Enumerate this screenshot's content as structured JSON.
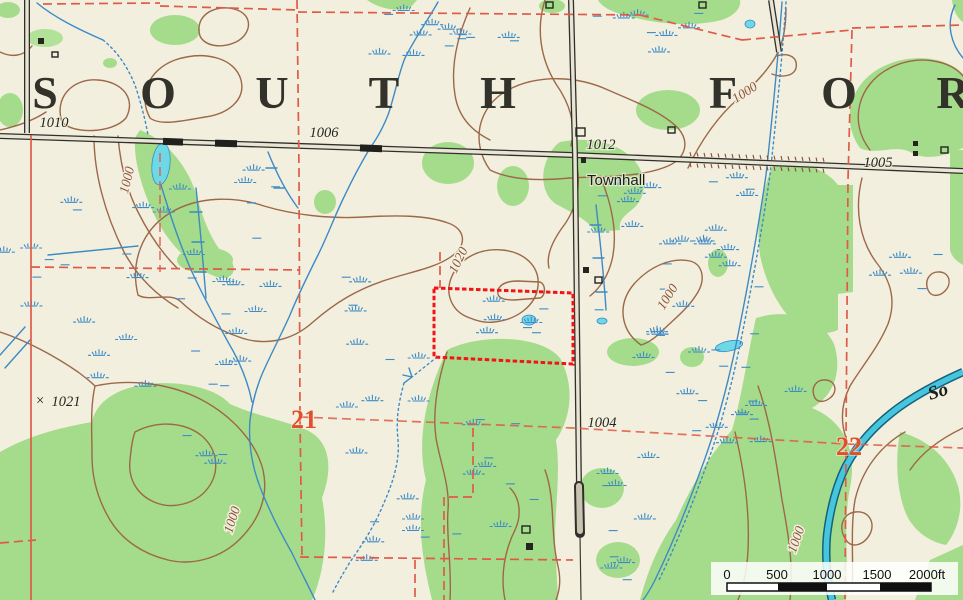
{
  "map_title": {
    "name_visible": "SOUTH FOR",
    "letters": [
      {
        "ch": "S",
        "x": 45
      },
      {
        "ch": "O",
        "x": 158
      },
      {
        "ch": "U",
        "x": 272
      },
      {
        "ch": "T",
        "x": 384
      },
      {
        "ch": "H",
        "x": 498
      },
      {
        "ch": "F",
        "x": 723
      },
      {
        "ch": "O",
        "x": 839
      },
      {
        "ch": "R",
        "x": 953
      }
    ],
    "baseline_y": 108
  },
  "place_labels": {
    "townhall": "Townhall",
    "river_name_partial": "So"
  },
  "contour_labels": [
    {
      "text": "1000",
      "x": 131,
      "y": 181,
      "rot": -76
    },
    {
      "text": "1020",
      "x": 462,
      "y": 262,
      "rot": -64
    },
    {
      "text": "1000",
      "x": 747,
      "y": 96,
      "rot": -33
    },
    {
      "text": "1000",
      "x": 671,
      "y": 299,
      "rot": -58
    },
    {
      "text": "1000",
      "x": 236,
      "y": 521,
      "rot": -72
    },
    {
      "text": "1000",
      "x": 800,
      "y": 541,
      "rot": -70
    }
  ],
  "spot_elevations": [
    {
      "text": "1010",
      "x": 54,
      "y": 127
    },
    {
      "text": "1006",
      "x": 324,
      "y": 137
    },
    {
      "text": "1012",
      "x": 601,
      "y": 149
    },
    {
      "text": "1005",
      "x": 878,
      "y": 167
    },
    {
      "text": "1004",
      "x": 602,
      "y": 427
    },
    {
      "text": "1021",
      "x": 66,
      "y": 406,
      "marker": "×"
    }
  ],
  "section_numbers": [
    {
      "text": "21",
      "x": 304,
      "y": 428
    },
    {
      "text": "22",
      "x": 849,
      "y": 455
    }
  ],
  "scale_bar": {
    "ticks": [
      {
        "label": "0",
        "x": 727
      },
      {
        "label": "500",
        "x": 777
      },
      {
        "label": "1000",
        "x": 827
      },
      {
        "label": "1500",
        "x": 877
      },
      {
        "label": "2000ft",
        "x": 927
      }
    ]
  },
  "colors": {
    "paper": "#F2EFDF",
    "vegetation": "#A5DC8B",
    "open_water": "#6FD8E6",
    "stream": "#3D8AC5",
    "contour": "#9C6848",
    "section_line": "#E05B47",
    "section_number": "#E44D2B",
    "parcel_outline": "#F21414",
    "road": "#30302B",
    "label_text": "#26261F"
  }
}
